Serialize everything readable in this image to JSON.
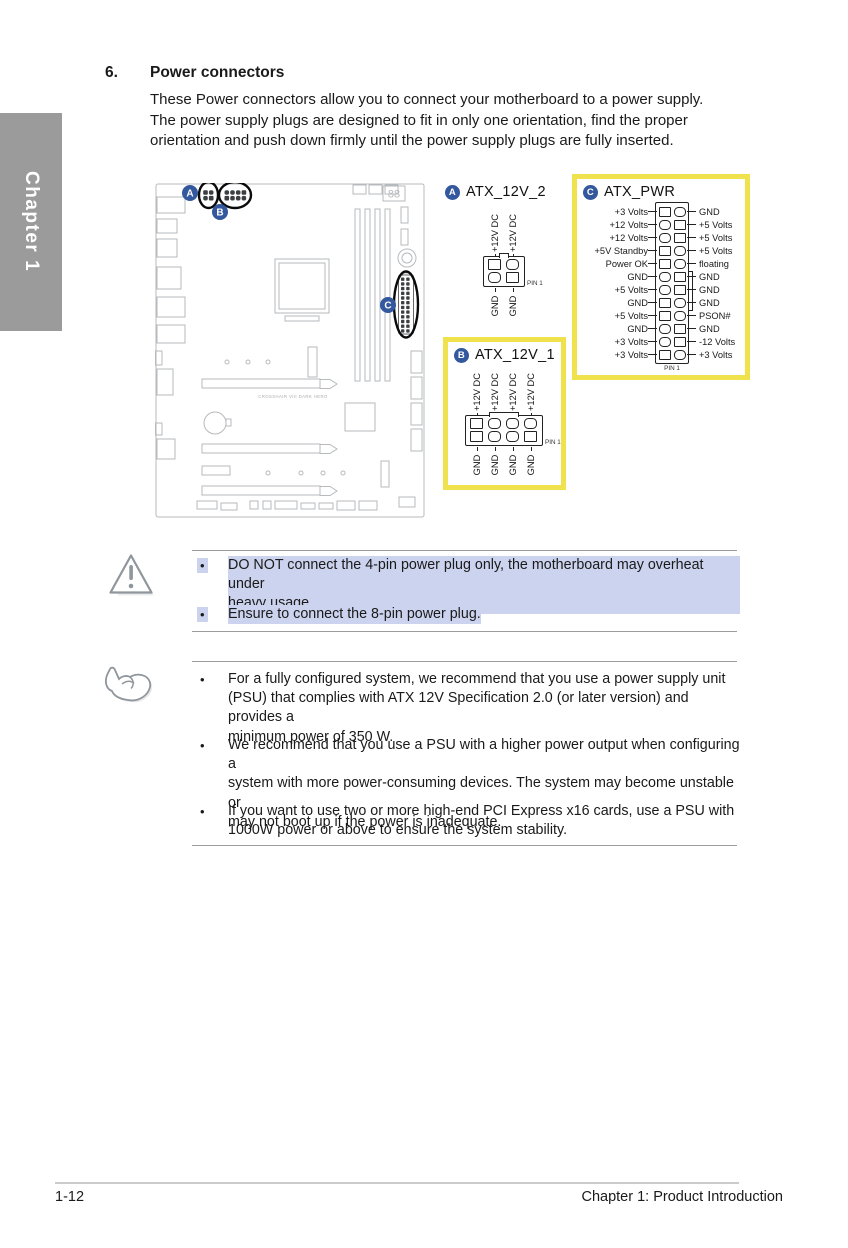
{
  "document": {
    "section_number": "6.",
    "section_title": "Power connectors",
    "intro": "These Power connectors allow you to connect your motherboard to a power supply.\nThe power supply plugs are designed to fit in only one orientation, find the proper\norientation and push down firmly until the power supply plugs are fully inserted.",
    "chapter_tab": "Chapter 1"
  },
  "board": {
    "model_text": "CROSSHAIR VIII DARK HERO",
    "debug_display": "88"
  },
  "connectors": {
    "atx12v2": {
      "badge": "A",
      "title": "ATX_12V_2",
      "top_labels": [
        "+12V DC",
        "+12V DC"
      ],
      "bottom_labels": [
        "GND",
        "GND"
      ],
      "top_shapes": [
        "sq",
        "rd"
      ],
      "bottom_shapes": [
        "rd",
        "sq"
      ],
      "pin1_label": "PIN 1"
    },
    "atx12v1": {
      "badge": "B",
      "title": "ATX_12V_1",
      "top_labels": [
        "+12V DC",
        "+12V DC",
        "+12V DC",
        "+12V DC"
      ],
      "bottom_labels": [
        "GND",
        "GND",
        "GND",
        "GND"
      ],
      "top_shapes": [
        "sq",
        "rd",
        "rd",
        "rd"
      ],
      "bottom_shapes": [
        "sq",
        "rd",
        "rd",
        "sq"
      ],
      "pin1_label": "PIN 1"
    },
    "atx_pwr": {
      "badge": "C",
      "title": "ATX_PWR",
      "pin1_label": "PIN 1",
      "rows": [
        {
          "left": "+3 Volts",
          "right": "GND",
          "ls": "sq",
          "rs": "rd"
        },
        {
          "left": "+12 Volts",
          "right": "+5 Volts",
          "ls": "rd",
          "rs": "sq"
        },
        {
          "left": "+12 Volts",
          "right": "+5 Volts",
          "ls": "rd",
          "rs": "sq"
        },
        {
          "left": "+5V Standby",
          "right": "+5 Volts",
          "ls": "sq",
          "rs": "rd"
        },
        {
          "left": "Power OK",
          "right": "floating",
          "ls": "sq",
          "rs": "rd"
        },
        {
          "left": "GND",
          "right": "GND",
          "ls": "rd",
          "rs": "sq"
        },
        {
          "left": "+5 Volts",
          "right": "GND",
          "ls": "rd",
          "rs": "sq"
        },
        {
          "left": "GND",
          "right": "GND",
          "ls": "sq",
          "rs": "rd"
        },
        {
          "left": "+5 Volts",
          "right": "PSON#",
          "ls": "sq",
          "rs": "rd"
        },
        {
          "left": "GND",
          "right": "GND",
          "ls": "rd",
          "rs": "sq"
        },
        {
          "left": "+3 Volts",
          "right": "-12 Volts",
          "ls": "rd",
          "rs": "sq"
        },
        {
          "left": "+3 Volts",
          "right": "+3 Volts",
          "ls": "sq",
          "rs": "rd"
        }
      ]
    }
  },
  "caution": {
    "bullets": [
      {
        "text": "DO NOT connect the 4-pin power plug only, the motherboard may overheat under\nheavy usage.",
        "highlighted": true
      },
      {
        "text": "Ensure to connect the 8-pin power plug.",
        "highlighted": true
      }
    ]
  },
  "notes": {
    "bullets": [
      {
        "text": "For a fully configured system, we recommend that you use a power supply unit\n(PSU) that complies with ATX 12V Specification 2.0 (or later version) and provides a\nminimum power of 350 W."
      },
      {
        "text": "We recommend that you use a PSU with a higher power output when configuring a\nsystem with more power-consuming devices. The system may become unstable or\nmay not boot up if the power is inadequate."
      },
      {
        "text": "If you want to use two or more high-end PCI Express x16 cards, use a PSU with\n1000W power or above to ensure the system stability."
      }
    ]
  },
  "footer": {
    "page_number": "1-12",
    "chapter_label": "Chapter 1: Product Introduction"
  },
  "colors": {
    "badge_blue": "#33589e",
    "highlight_yellow": "#f0e24d",
    "highlight_lavender": "#ccd3ee",
    "tab_gray": "#9b9b9b"
  }
}
